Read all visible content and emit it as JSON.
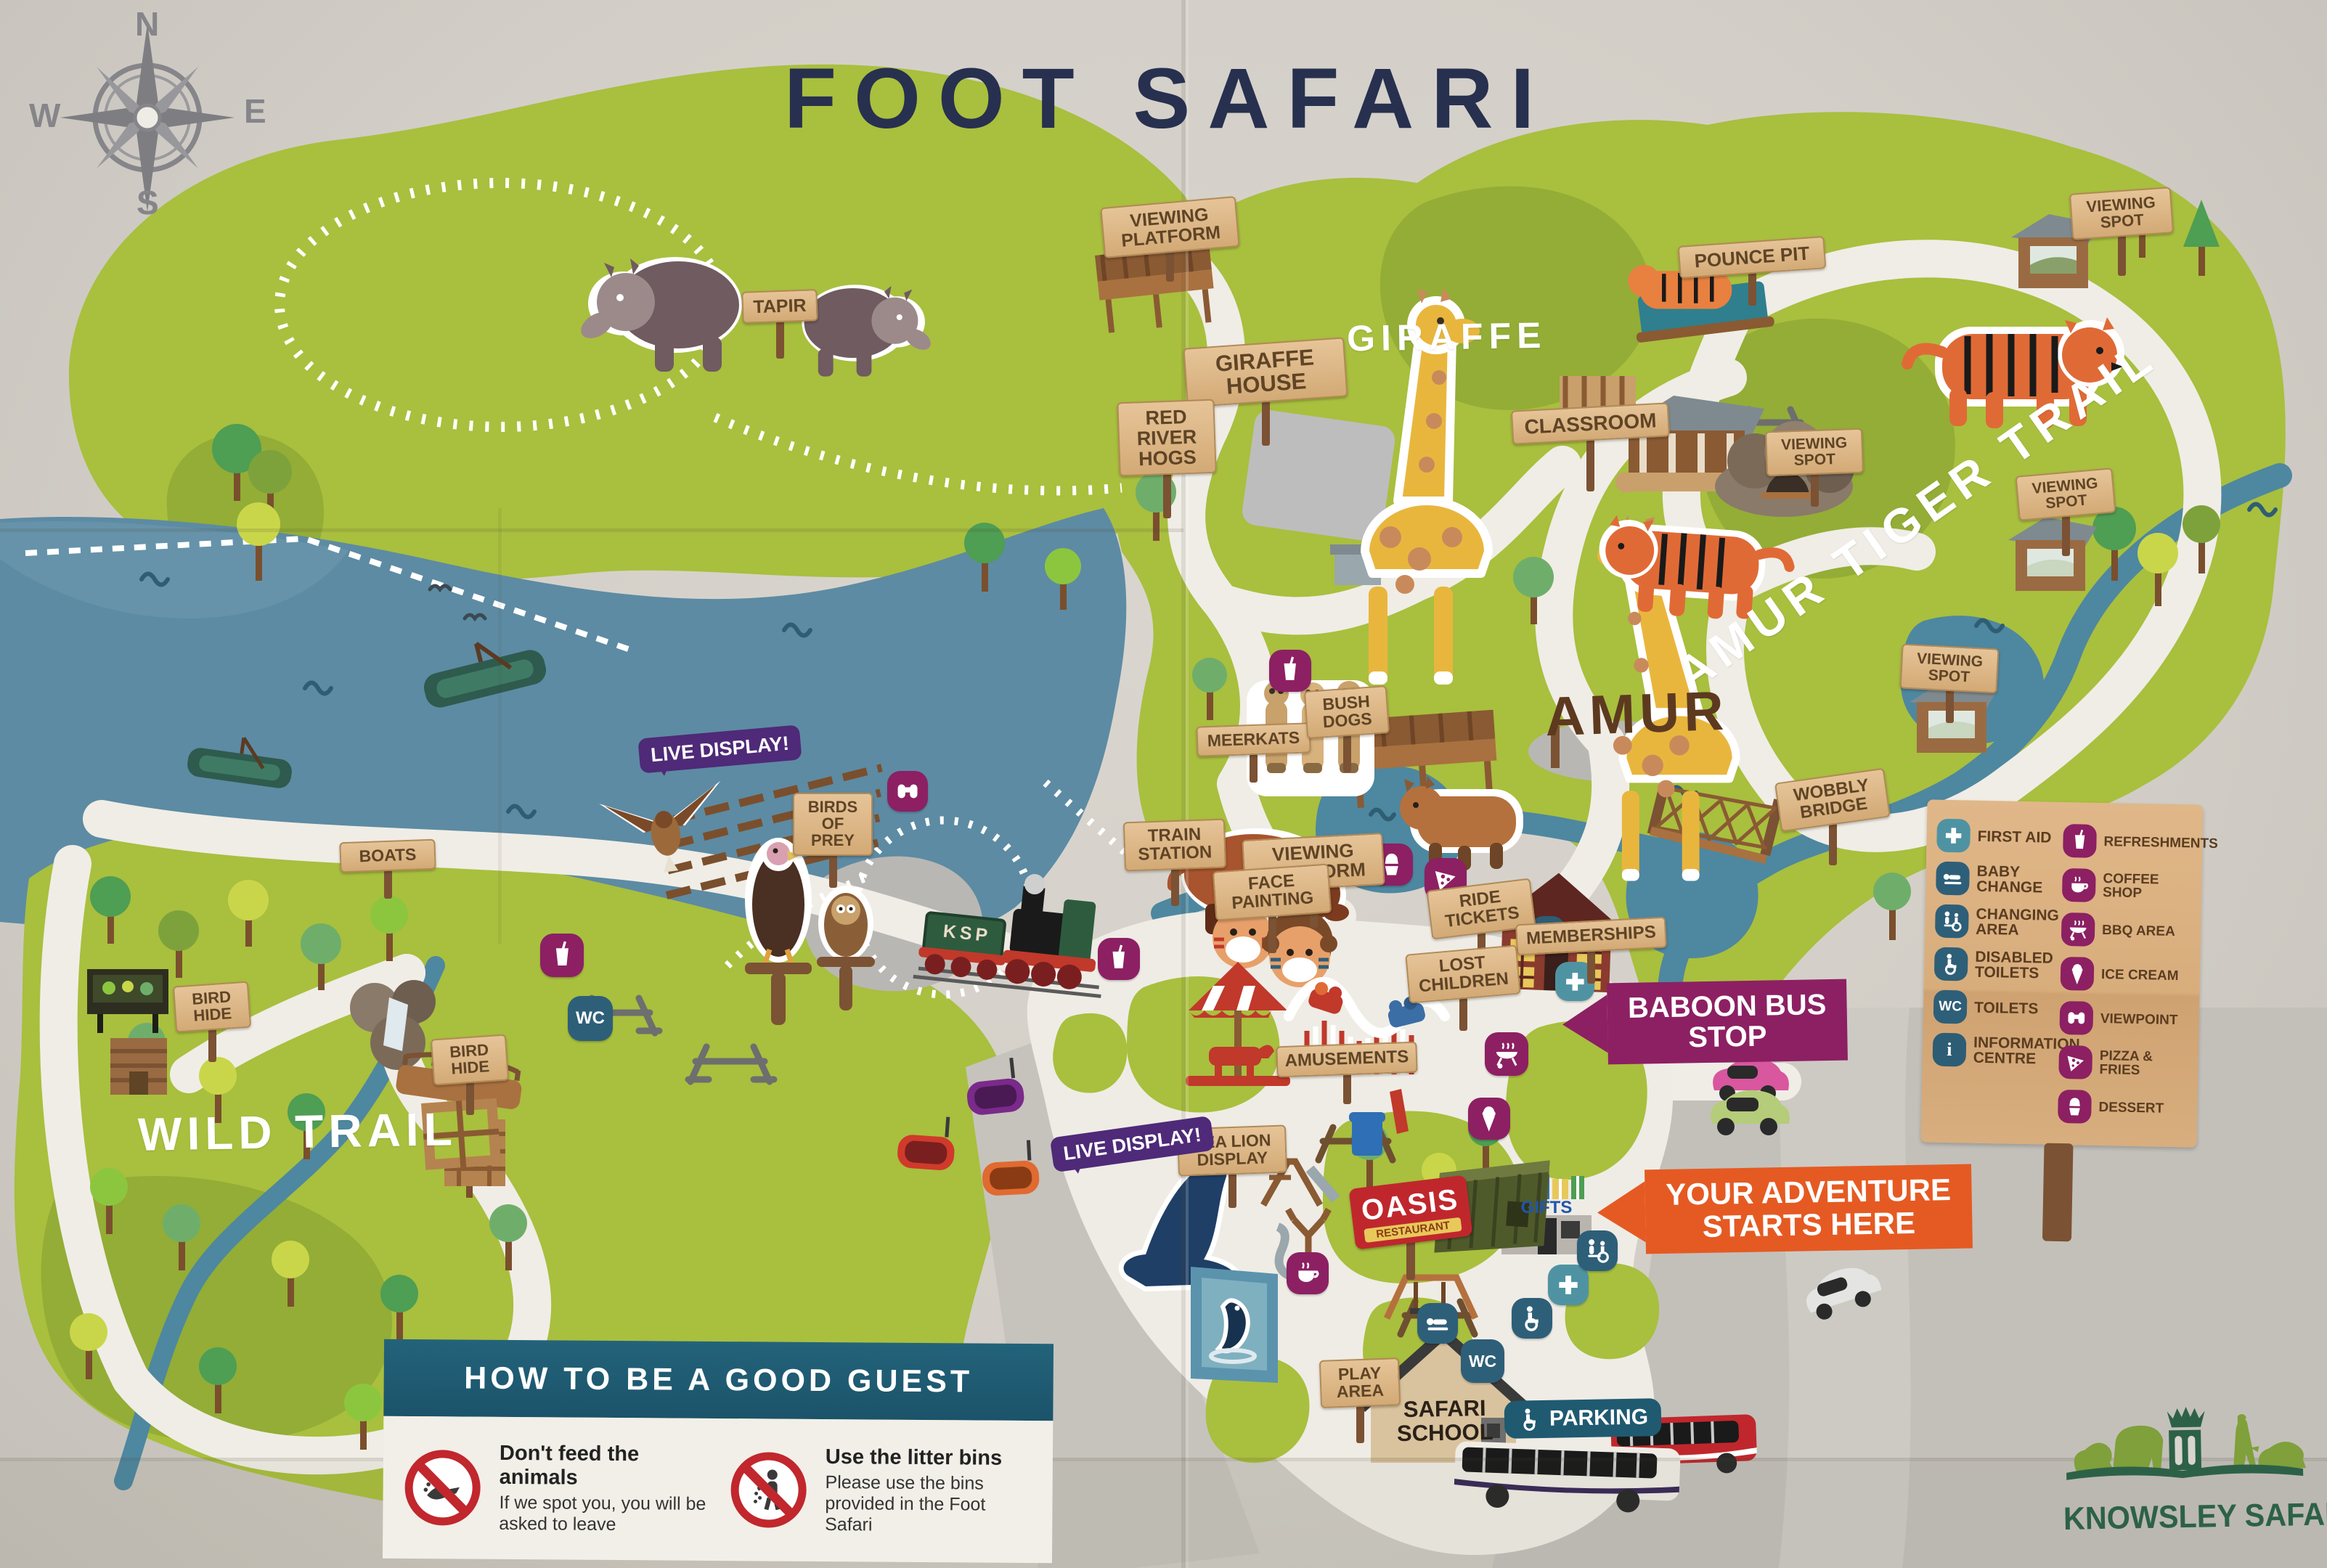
{
  "title": "FOOT SAFARI",
  "compass": {
    "n": "N",
    "e": "E",
    "s": "S",
    "w": "W"
  },
  "areas": {
    "giraffe": "GIRAFFE",
    "amur_gate": "AMUR",
    "tiger_trail": "AMUR TIGER TRAIL",
    "wild_trail": "WILD TRAIL"
  },
  "signs": {
    "tapir": "TAPIR",
    "viewing_platform": "VIEWING PLATFORM",
    "giraffe_house": "GIRAFFE HOUSE",
    "red_river_hogs": "RED RIVER HOGS",
    "pounce_pit": "POUNCE PIT",
    "classroom": "CLASSROOM",
    "viewing_spot": "VIEWING SPOT",
    "wobbly_bridge": "WOBBLY BRIDGE",
    "meerkats": "MEERKATS",
    "bush_dogs": "BUSH DOGS",
    "boats": "BOATS",
    "bird_hide": "BIRD HIDE",
    "birds_of_prey": "BIRDS OF PREY",
    "train_station": "TRAIN STATION",
    "face_painting": "FACE PAINTING",
    "ride_tickets": "RIDE TICKETS",
    "memberships": "MEMBERSHIPS",
    "lost_children": "LOST CHILDREN",
    "amusements": "AMUSEMENTS",
    "sea_lion_display": "SEA LION DISPLAY",
    "play_area": "PLAY AREA",
    "safari_school": "SAFARI SCHOOL",
    "parking": "PARKING",
    "gifts": "GIFTS",
    "oasis_line1": "OASIS",
    "oasis_line2": "RESTAURANT"
  },
  "banners": {
    "live_display": "LIVE DISPLAY!",
    "baboon_bus_stop": "BABOON BUS STOP",
    "adventure": "YOUR ADVENTURE STARTS HERE"
  },
  "badges": {
    "wc": "WC",
    "info": "i",
    "train": "KSP"
  },
  "legend": {
    "left": [
      {
        "icon": "first-aid-icon",
        "label": "FIRST AID"
      },
      {
        "icon": "baby-change-icon",
        "label": "BABY CHANGE"
      },
      {
        "icon": "changing-area-icon",
        "label": "CHANGING AREA"
      },
      {
        "icon": "disabled-toilets-icon",
        "label": "DISABLED TOILETS"
      },
      {
        "icon": "toilets-icon",
        "label": "TOILETS"
      },
      {
        "icon": "information-centre-icon",
        "label": "INFORMATION CENTRE"
      }
    ],
    "right": [
      {
        "icon": "refreshments-icon",
        "label": "REFRESHMENTS"
      },
      {
        "icon": "coffee-shop-icon",
        "label": "COFFEE SHOP"
      },
      {
        "icon": "bbq-area-icon",
        "label": "BBQ AREA"
      },
      {
        "icon": "ice-cream-icon",
        "label": "ICE CREAM"
      },
      {
        "icon": "viewpoint-icon",
        "label": "VIEWPOINT"
      },
      {
        "icon": "pizza-fries-icon",
        "label": "PIZZA & FRIES"
      },
      {
        "icon": "dessert-icon",
        "label": "DESSERT"
      }
    ]
  },
  "good_guest": {
    "title": "HOW TO BE A GOOD GUEST",
    "rules": [
      {
        "title": "Don't feed the animals",
        "body": "If we spot you, you will be asked to leave"
      },
      {
        "title": "Use the litter bins",
        "body": "Please use the bins provided in the Foot Safari"
      }
    ]
  },
  "logo": {
    "text": "KNOWSLEY SAFARI"
  },
  "colors": {
    "title_navy": "#27304e",
    "purple": "#8c2063",
    "violet": "#4e2a78",
    "orange": "#e55a22",
    "teal_header": "#1d5a70",
    "sign_tan": "#d9b587",
    "green": "#a9bf3e",
    "lake": "#5d8ba3",
    "logo_green": "#2d6147",
    "prohibition_red": "#c1272d"
  }
}
